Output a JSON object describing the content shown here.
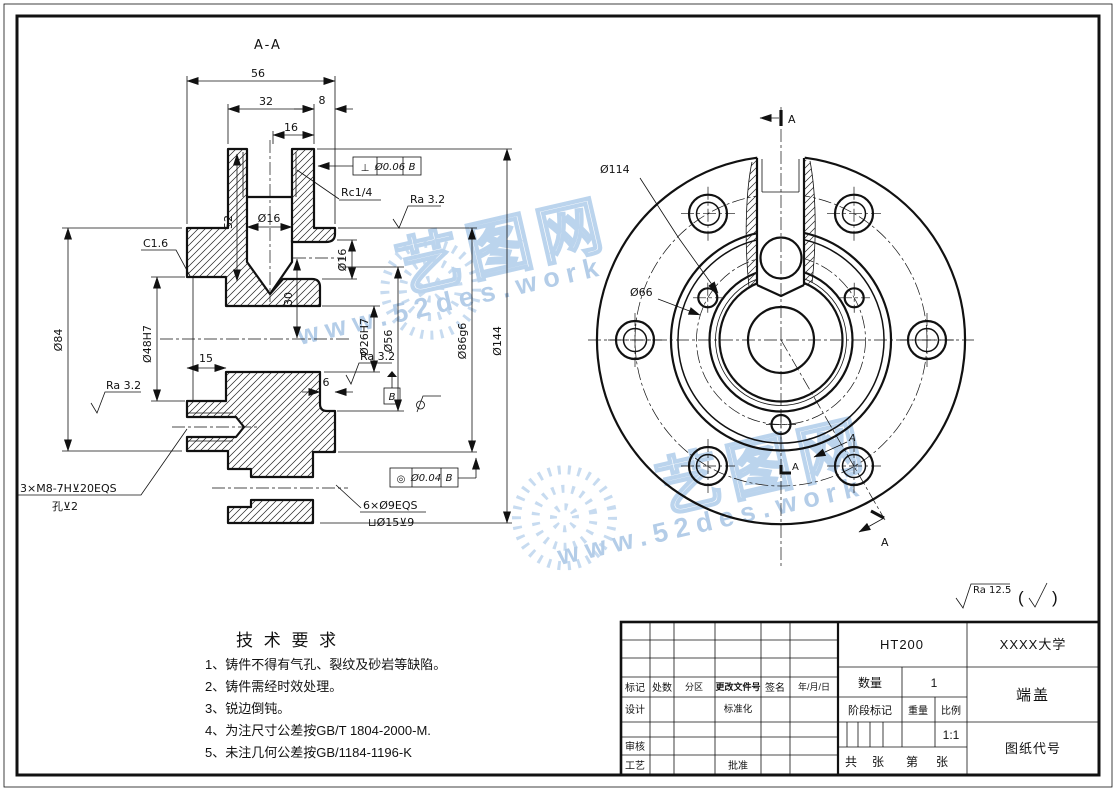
{
  "watermark": {
    "brand": "艺图网",
    "site": "www.52des.work",
    "color": "#a9c8e8"
  },
  "views": {
    "section_label": "A-A",
    "left": {
      "dim_56": "56",
      "dim_32": "32",
      "dim_8": "8",
      "dim_16": "16",
      "dim_52": "52",
      "dia16_bore": "Ø16",
      "rc_thread": "Rc1/4",
      "ra32": "Ra 3.2",
      "chamfer": "C1.6",
      "dia84": "Ø84",
      "dia48": "Ø48H7",
      "dim_15": "15",
      "dia16_side": "Ø16",
      "dim_30": "30",
      "dia26": "Ø26H7",
      "dia56": "Ø56",
      "dim_6": "6",
      "dia86": "Ø86g6",
      "dia144": "Ø144",
      "datum_b": "B",
      "fcf_perp": {
        "sym": "⊥",
        "tol": "Ø0.06",
        "datum": "B"
      },
      "fcf_conc": {
        "sym": "◎",
        "tol": "Ø0.04",
        "datum": "B"
      },
      "note_m8_line1": "3×M8-7H⊻20EQS",
      "note_m8_line2": "孔⊻2",
      "note_holes_line1": "6×Ø9EQS",
      "note_holes_line2": "⊔Ø15⊻9"
    },
    "right": {
      "dia114": "Ø114",
      "dia66": "Ø66",
      "arrow_label": "A"
    },
    "finish_note": {
      "ra": "Ra 12.5",
      "paren_open": "(",
      "paren_close": ")"
    }
  },
  "tech_requirements": {
    "title": "技 术 要 求",
    "items": [
      "1、铸件不得有气孔、裂纹及砂岩等缺陷。",
      "2、铸件需经时效处理。",
      "3、锐边倒钝。",
      "4、为注尺寸公差按GB/T 1804-2000-M.",
      "5、未注几何公差按GB/1184-1196-K"
    ]
  },
  "title_block": {
    "material": "HT200",
    "company": "XXXX大学",
    "part_name": "端盖",
    "drawing_no_label": "图纸代号",
    "qty_label": "数量",
    "qty_value": "1",
    "stage_label": "阶段标记",
    "weight_label": "重量",
    "scale_label": "比例",
    "scale_value": "1:1",
    "sheet_total_label": "共",
    "sheet_total_unit": "张",
    "sheet_no_label": "第",
    "sheet_no_unit": "张",
    "rev_headers": [
      "标记",
      "处数",
      "分区",
      "更改文件号",
      "签名",
      "年/月/日"
    ],
    "row_design": "设计",
    "row_standard": "标准化",
    "row_review": "审核",
    "row_process": "工艺",
    "row_approve": "批准"
  }
}
